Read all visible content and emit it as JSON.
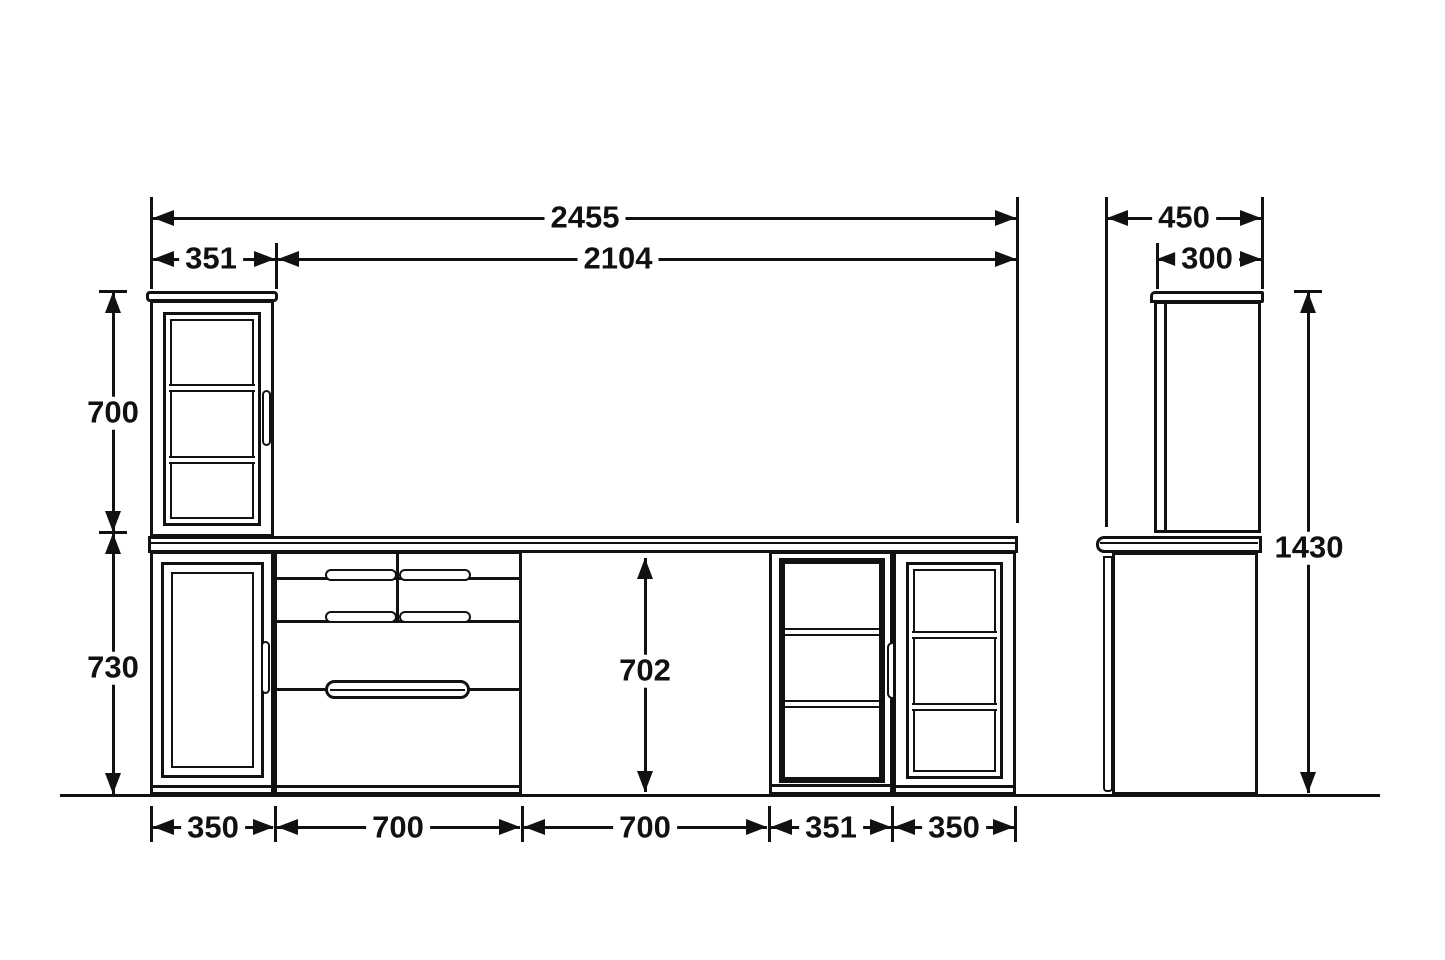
{
  "drawing": {
    "type": "furniture-dimension-drawing",
    "colors": {
      "line": "#111111",
      "background": "#ffffff"
    }
  },
  "dims": {
    "total_width": "2455",
    "span_right": "2104",
    "upper_cabinet_width": "351",
    "upper_cabinet_height": "700",
    "base_cabinet_height": "730",
    "opening_height": "702",
    "bottom_widths": [
      "350",
      "700",
      "700",
      "351",
      "350"
    ],
    "side_depth": "450",
    "side_upper_depth": "300",
    "overall_height": "1430"
  }
}
